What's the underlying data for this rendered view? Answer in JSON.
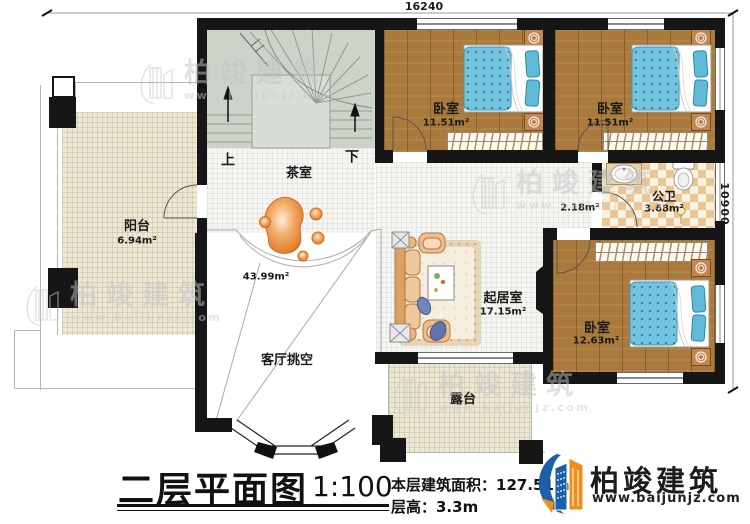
{
  "dimensions": {
    "top": "16240",
    "right": "10900"
  },
  "rooms": {
    "balcony": {
      "label": "阳台",
      "area": "6.94m²"
    },
    "tea_room": {
      "label": "茶室",
      "area": "43.99m²"
    },
    "stairs": {
      "up": "上",
      "down": "下"
    },
    "living_void": {
      "label": "客厅挑空"
    },
    "bedroom_a": {
      "label": "卧室",
      "area": "11.51m²"
    },
    "bedroom_b": {
      "label": "卧室",
      "area": "11.51m²"
    },
    "bedroom_c": {
      "label": "卧室",
      "area": "12.63m²"
    },
    "bathroom": {
      "label": "公卫",
      "area": "3.68m²"
    },
    "hallway": {
      "area": "2.18m²"
    },
    "sitting_room": {
      "label": "起居室",
      "area": "17.15m²"
    },
    "terrace": {
      "label": "露台"
    }
  },
  "title_block": {
    "title": "二层平面图",
    "scale": "1:100",
    "floor_area": "本层建筑面积：127.51m²",
    "floor_height": "层高：3.3m"
  },
  "brand": {
    "name": "柏竣建筑",
    "website": "www.baijunjz.com"
  },
  "colors": {
    "wall": "#161616",
    "brand_blue": "#1a61a8",
    "brand_orange": "#ef8f1a",
    "wood_floor": "#a97a3c",
    "mattress_blue": "#74c4df",
    "tile_cream": "#ece8d5"
  }
}
